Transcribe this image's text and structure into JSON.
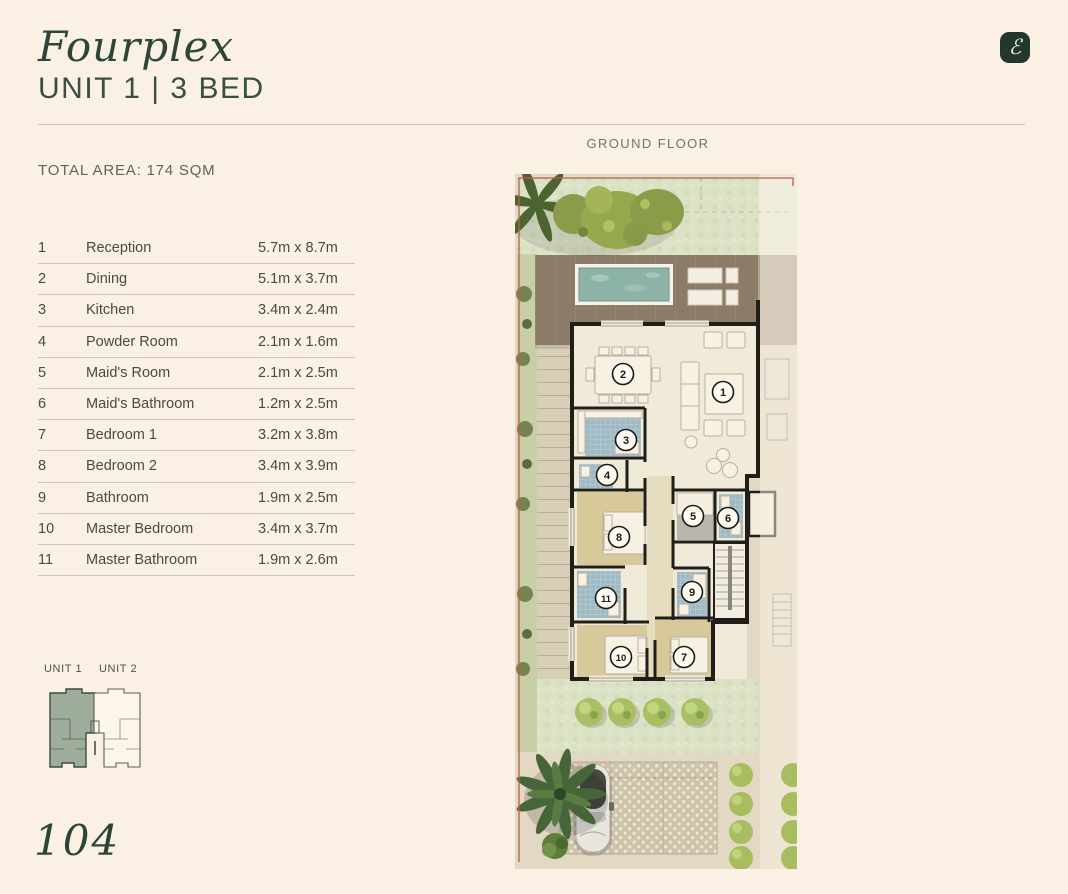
{
  "header": {
    "title": "Fourplex",
    "subtitle": "UNIT 1 | 3 BED"
  },
  "logo": {
    "monogram": "ℰ"
  },
  "summary": {
    "total_area": "TOTAL AREA: 174 SQM"
  },
  "plan": {
    "floor_label": "GROUND FLOOR",
    "markers": [
      {
        "num": "1",
        "x": 208,
        "y": 218
      },
      {
        "num": "2",
        "x": 108,
        "y": 200
      },
      {
        "num": "3",
        "x": 111,
        "y": 266
      },
      {
        "num": "4",
        "x": 92,
        "y": 301
      },
      {
        "num": "5",
        "x": 178,
        "y": 342
      },
      {
        "num": "6",
        "x": 213,
        "y": 344
      },
      {
        "num": "7",
        "x": 169,
        "y": 483
      },
      {
        "num": "8",
        "x": 104,
        "y": 363
      },
      {
        "num": "9",
        "x": 177,
        "y": 418
      },
      {
        "num": "10",
        "x": 106,
        "y": 483
      },
      {
        "num": "11",
        "x": 91,
        "y": 424
      }
    ]
  },
  "rooms": {
    "items": [
      {
        "num": "1",
        "name": "Reception",
        "dims": "5.7m x 8.7m"
      },
      {
        "num": "2",
        "name": "Dining",
        "dims": "5.1m x 3.7m"
      },
      {
        "num": "3",
        "name": "Kitchen",
        "dims": "3.4m x 2.4m"
      },
      {
        "num": "4",
        "name": "Powder Room",
        "dims": "2.1m x 1.6m"
      },
      {
        "num": "5",
        "name": "Maid's Room",
        "dims": "2.1m x 2.5m"
      },
      {
        "num": "6",
        "name": "Maid's Bathroom",
        "dims": "1.2m x 2.5m"
      },
      {
        "num": "7",
        "name": "Bedroom 1",
        "dims": "3.2m x 3.8m"
      },
      {
        "num": "8",
        "name": "Bedroom 2",
        "dims": "3.4m x 3.9m"
      },
      {
        "num": "9",
        "name": "Bathroom",
        "dims": "1.9m x 2.5m"
      },
      {
        "num": "10",
        "name": "Master Bedroom",
        "dims": "3.4m x 3.7m"
      },
      {
        "num": "11",
        "name": "Master Bathroom",
        "dims": "1.9m x 2.6m"
      }
    ]
  },
  "locator": {
    "unit1": "UNIT 1",
    "unit2": "UNIT 2"
  },
  "footer": {
    "page_number": "104"
  },
  "colors": {
    "background": "#faf1e4",
    "accent_green": "#2c463a",
    "boundary_red": "#bf5a4c",
    "pool_teal": "#8db3a9",
    "deck_brown": "#8c7b67",
    "grass_green": "#dbe2c6",
    "bedroom_tan": "#d8c99b",
    "tile_blue": "#9fbac5",
    "wall_black": "#211e19"
  }
}
